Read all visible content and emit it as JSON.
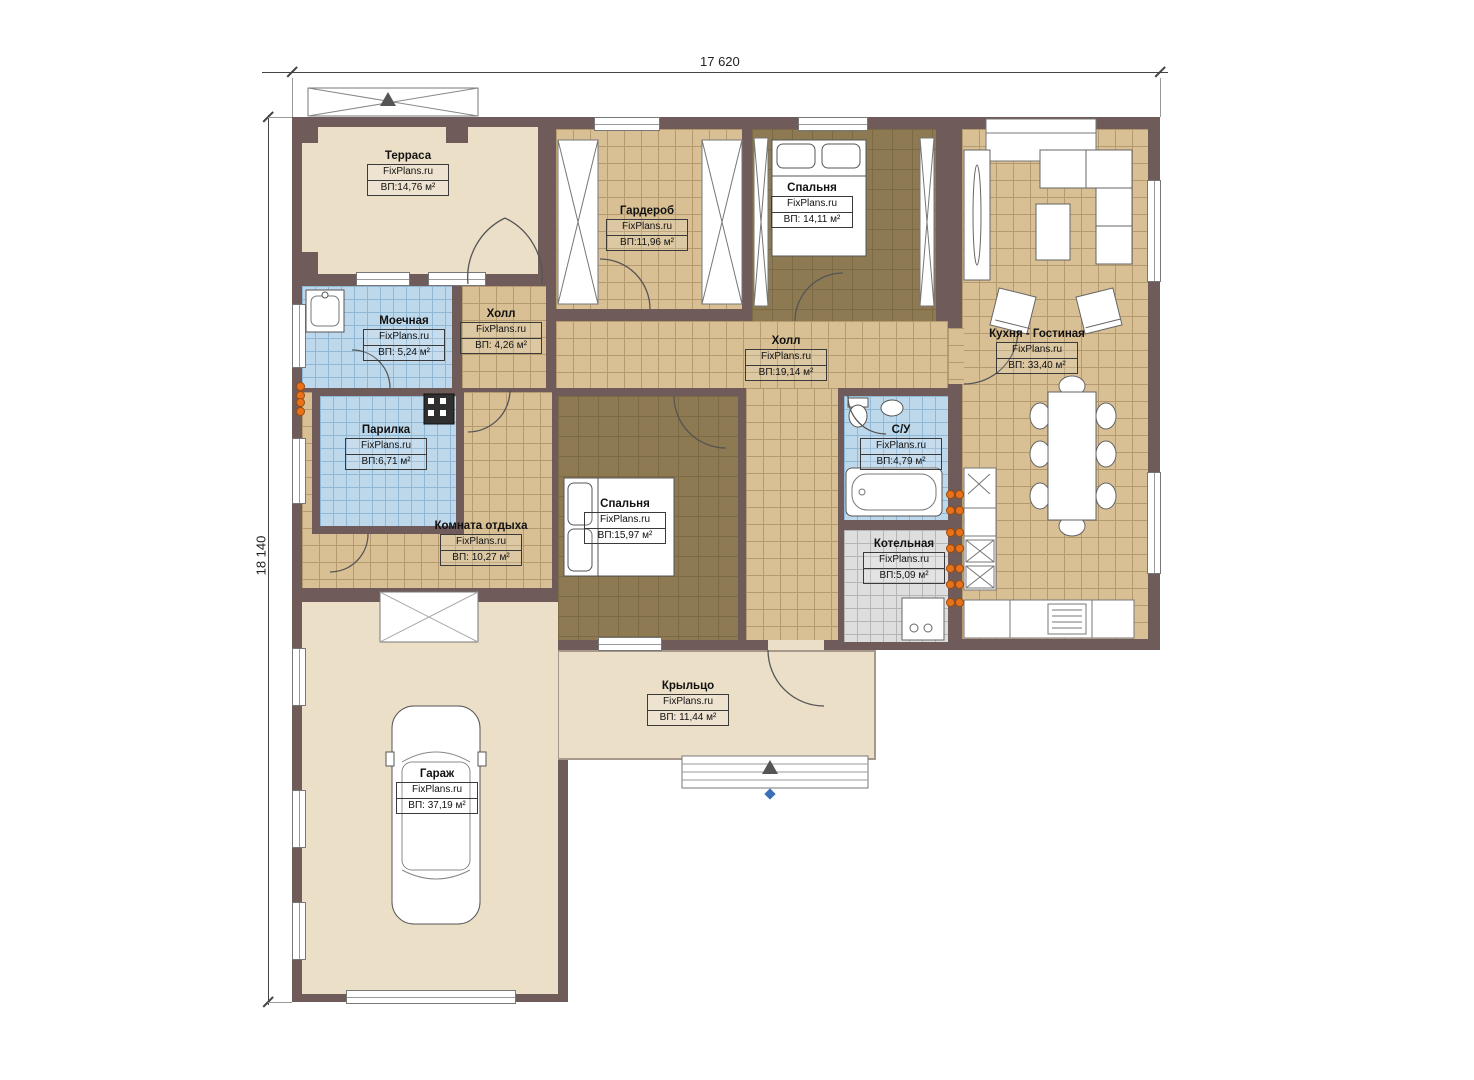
{
  "dimensions": {
    "top": "17 620",
    "left": "18 140"
  },
  "colors": {
    "wall": "#6F5B59",
    "floor_beige": "#ECDFC8",
    "floor_tile_tan": "#D8BF94",
    "floor_carpet": "#8D7952",
    "floor_tile_blue": "#BED8EB",
    "floor_tile_gray": "#DEDEDE",
    "outlet": "#E8721C"
  },
  "rooms": [
    {
      "id": "terrace",
      "name": "Терраса",
      "brand": "FixPlans.ru",
      "area": "ВП:14,76 м²"
    },
    {
      "id": "wardrobe",
      "name": "Гардероб",
      "brand": "FixPlans.ru",
      "area": "ВП:11,96 м²"
    },
    {
      "id": "bedroom1",
      "name": "Спальня",
      "brand": "FixPlans.ru",
      "area": "ВП: 14,11 м²"
    },
    {
      "id": "kitchen",
      "name": "Кухня - Гостиная",
      "brand": "FixPlans.ru",
      "area": "ВП: 33,40 м²"
    },
    {
      "id": "washroom",
      "name": "Моечная",
      "brand": "FixPlans.ru",
      "area": "ВП: 5,24 м²"
    },
    {
      "id": "hall2",
      "name": "Холл",
      "brand": "FixPlans.ru",
      "area": "ВП: 4,26 м²"
    },
    {
      "id": "sauna",
      "name": "Парилка",
      "brand": "FixPlans.ru",
      "area": "ВП:6,71 м²"
    },
    {
      "id": "hall",
      "name": "Холл",
      "brand": "FixPlans.ru",
      "area": "ВП:19,14 м²"
    },
    {
      "id": "rest",
      "name": "Комната отдыха",
      "brand": "FixPlans.ru",
      "area": "ВП: 10,27 м²"
    },
    {
      "id": "bedroom2",
      "name": "Спальня",
      "brand": "FixPlans.ru",
      "area": "ВП:15,97 м²"
    },
    {
      "id": "bath",
      "name": "С/У",
      "brand": "FixPlans.ru",
      "area": "ВП:4,79 м²"
    },
    {
      "id": "boiler",
      "name": "Котельная",
      "brand": "FixPlans.ru",
      "area": "ВП:5,09 м²"
    },
    {
      "id": "porch",
      "name": "Крыльцо",
      "brand": "FixPlans.ru",
      "area": "ВП: 11,44 м²"
    },
    {
      "id": "garage",
      "name": "Гараж",
      "brand": "FixPlans.ru",
      "area": "ВП: 37,19 м²"
    }
  ]
}
